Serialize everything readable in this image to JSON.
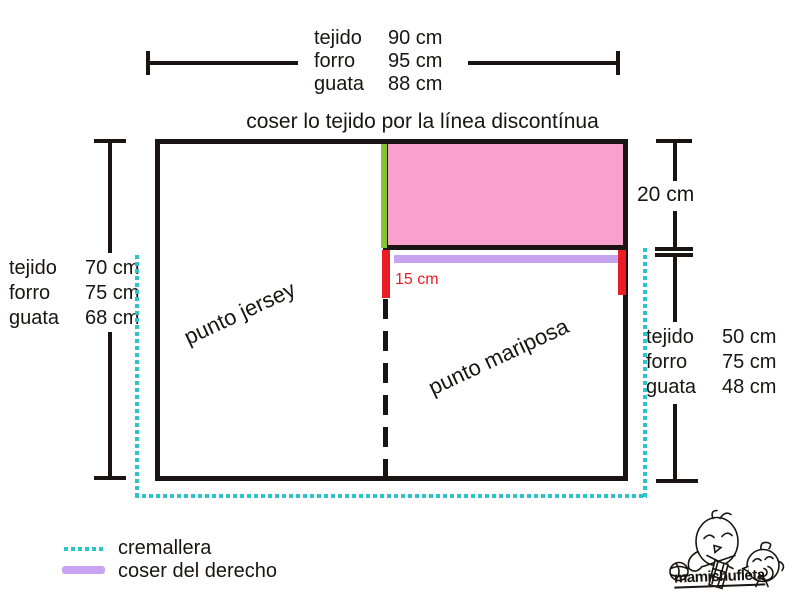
{
  "colors": {
    "outline": "#1a1414",
    "pink_fill": "#f9a0cc",
    "green_seam": "#86c436",
    "purple_seam": "#c8a4f0",
    "red_mark": "#ec1c24",
    "cyan_zipper": "#2bc4cd"
  },
  "top_measurements": {
    "rows": [
      {
        "label": "tejido",
        "value": "90 cm"
      },
      {
        "label": "forro",
        "value": "95 cm"
      },
      {
        "label": "guata",
        "value": "88 cm"
      }
    ]
  },
  "instruction": "coser lo tejido por la línea discontínua",
  "left_measurements": {
    "rows": [
      {
        "label": "tejido",
        "value": "70 cm"
      },
      {
        "label": "forro",
        "value": "75 cm"
      },
      {
        "label": "guata",
        "value": "68 cm"
      }
    ]
  },
  "right_measurements": {
    "rows": [
      {
        "label": "tejido",
        "value": "50 cm"
      },
      {
        "label": "forro",
        "value": "75 cm"
      },
      {
        "label": "guata",
        "value": "48 cm"
      }
    ]
  },
  "panel_labels": {
    "left": "punto jersey",
    "right": "punto mariposa"
  },
  "dimensions": {
    "pink_height": "20 cm",
    "seam": "15 cm"
  },
  "legend": {
    "items": [
      {
        "icon": "cyan-dotted-line",
        "label": "cremallera"
      },
      {
        "icon": "purple-solid-line",
        "label": "coser del derecho"
      }
    ]
  },
  "logo": {
    "brand": "mamichufleta"
  }
}
